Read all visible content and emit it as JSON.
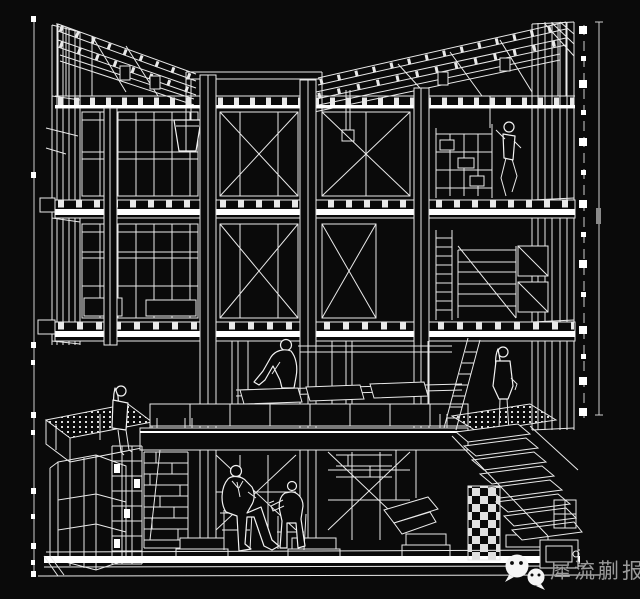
{
  "canvas": {
    "background_color": "#0a0a0a",
    "line_color": "#e9e9e9",
    "highlight_color": "#ffffff"
  },
  "drawing": {
    "subject": "Cutaway sectional perspective of a multi-storey timber/steel frame building",
    "style": "white wireframe linework on black",
    "features": [
      "butterfly roof with exposed rafters",
      "two upper window floors with X cross-bracing",
      "mezzanine platform with tiered benches and planter",
      "basement with scaffolding columns, brick walls and stairs",
      "six human figures (sitting, standing, climbing)"
    ]
  },
  "dimension_marks": {
    "left_rule": "vertical dimension line with tick squares",
    "right_rule": "vertical dimension line with tick squares"
  },
  "watermark": {
    "text": "犀流蒯报",
    "color": "#9a9a9a",
    "icon": "wechat-chat-bubbles-icon"
  }
}
